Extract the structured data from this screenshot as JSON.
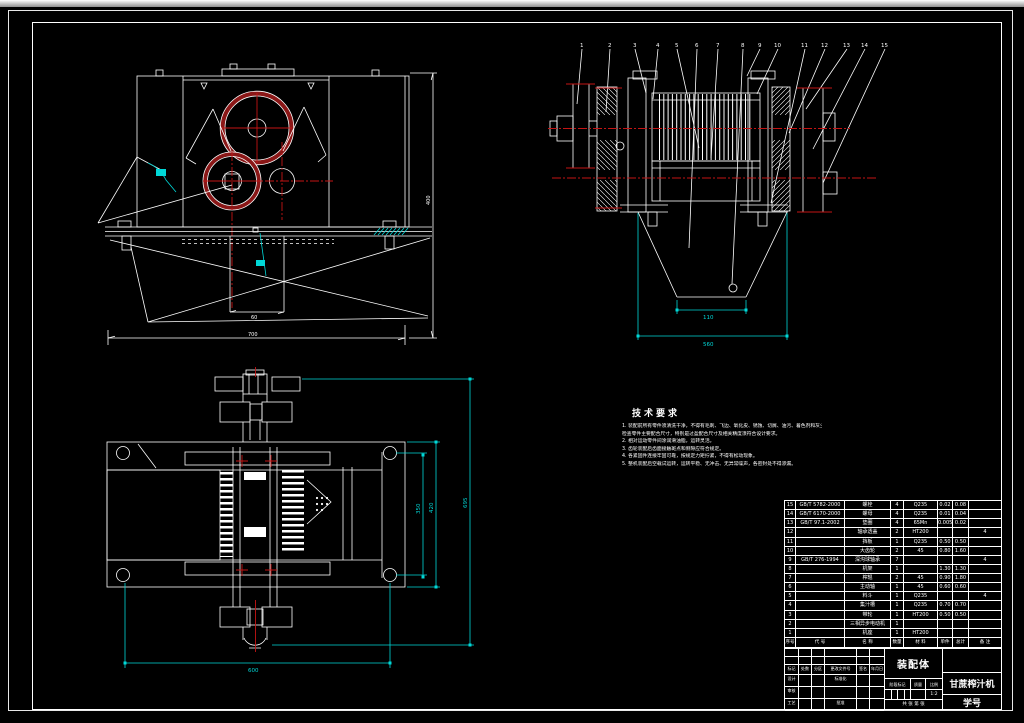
{
  "colors": {
    "background": "#000000",
    "line": "#ffffff",
    "centerline_red": "#c41414",
    "gear_rim_maroon": "#8b1717",
    "dimension_cyan": "#00d8d8"
  },
  "tech": {
    "title": "技术要求",
    "lines": [
      "1. 装配前所有零件须清洗干净，不得有毛刺、飞边、氧化皮、锈蚀、切屑、油污、着色剂和灰尘等。",
      "   检查零件主要配合尺寸，特别是过盈配合尺寸及相关精度须符合设计要求。",
      "2. 相对运动零件间涂润滑油脂，运转灵活。",
      "3. 齿轮装配后齿面接触斑点和侧隙应符合规定。",
      "4. 各紧固件连接牢固可靠，按规定力矩拧紧，不得有松动现象。",
      "5. 整机装配后空载试运转，运转平稳、无冲击、无异常噪声，各密封处不得渗漏。"
    ]
  },
  "bom": {
    "headers": {
      "no": "序号",
      "code": "代 号",
      "name": "名 称",
      "qty": "数量",
      "material": "材 料",
      "unit": "单件",
      "total": "总计",
      "remark": "备 注"
    },
    "rows": [
      {
        "no": "15",
        "code": "GB/T 5782-2000",
        "name": "螺栓",
        "qty": "4",
        "material": "Q235",
        "unit": "0.02",
        "total": "0.08",
        "remark": ""
      },
      {
        "no": "14",
        "code": "GB/T 6170-2000",
        "name": "螺母",
        "qty": "4",
        "material": "Q235",
        "unit": "0.01",
        "total": "0.04",
        "remark": ""
      },
      {
        "no": "13",
        "code": "GB/T 97.1-2002",
        "name": "垫圈",
        "qty": "4",
        "material": "65Mn",
        "unit": "0.005",
        "total": "0.02",
        "remark": ""
      },
      {
        "no": "12",
        "code": "",
        "name": "轴承透盖",
        "qty": "2",
        "material": "HT200",
        "unit": "",
        "total": "",
        "remark": "4"
      },
      {
        "no": "11",
        "code": "",
        "name": "挡板",
        "qty": "1",
        "material": "Q235",
        "unit": "0.50",
        "total": "0.50",
        "remark": ""
      },
      {
        "no": "10",
        "code": "",
        "name": "大齿轮",
        "qty": "2",
        "material": "45",
        "unit": "0.80",
        "total": "1.60",
        "remark": ""
      },
      {
        "no": "9",
        "code": "GB/T 276-1994",
        "name": "深沟球轴承",
        "qty": "7",
        "material": "",
        "unit": "",
        "total": "",
        "remark": "4"
      },
      {
        "no": "8",
        "code": "",
        "name": "机架",
        "qty": "1",
        "material": "",
        "unit": "1.30",
        "total": "1.30",
        "remark": ""
      },
      {
        "no": "7",
        "code": "",
        "name": "榨辊",
        "qty": "2",
        "material": "45",
        "unit": "0.90",
        "total": "1.80",
        "remark": ""
      },
      {
        "no": "6",
        "code": "",
        "name": "主动轴",
        "qty": "1",
        "material": "45",
        "unit": "0.60",
        "total": "0.60",
        "remark": ""
      },
      {
        "no": "5",
        "code": "",
        "name": "料斗",
        "qty": "1",
        "material": "Q235",
        "unit": "",
        "total": "",
        "remark": "4"
      },
      {
        "no": "4",
        "code": "",
        "name": "集汁槽",
        "qty": "1",
        "material": "Q235",
        "unit": "0.70",
        "total": "0.70",
        "remark": ""
      },
      {
        "no": "3",
        "code": "",
        "name": "带轮",
        "qty": "1",
        "material": "HT200",
        "unit": "0.50",
        "total": "0.50",
        "remark": ""
      },
      {
        "no": "2",
        "code": "",
        "name": "三相异步电动机",
        "qty": "1",
        "material": "",
        "unit": "",
        "total": "",
        "remark": ""
      },
      {
        "no": "1",
        "code": "",
        "name": "机座",
        "qty": "1",
        "material": "HT200",
        "unit": "",
        "total": "",
        "remark": ""
      }
    ]
  },
  "tb": {
    "drawing_title": "装配体",
    "product_name": "甘蔗榨汁机",
    "student_no": "学号",
    "stage_mark": "阶段标记",
    "mass": "质量",
    "scale": "比例",
    "scale_value": "1:2",
    "sheet": "共 张 第 张",
    "sig": {
      "mark": "标记",
      "count": "处数",
      "zone": "分区",
      "doc": "更改文件号",
      "sign": "签名",
      "date": "年月日",
      "design": "设计",
      "std": "标准化",
      "review": "审核",
      "process": "工艺",
      "approve": "批准"
    }
  },
  "balloons": [
    "1",
    "2",
    "3",
    "4",
    "5",
    "6",
    "7",
    "8",
    "9",
    "10",
    "11",
    "12",
    "13",
    "14",
    "15"
  ],
  "dims": {
    "front_width": "700",
    "front_height": "400",
    "front_chute": "60",
    "side_inner": "110",
    "side_outer": "560",
    "sec_bottom": "600",
    "sec_h1": "350",
    "sec_h2": "420",
    "sec_h3": "695"
  }
}
